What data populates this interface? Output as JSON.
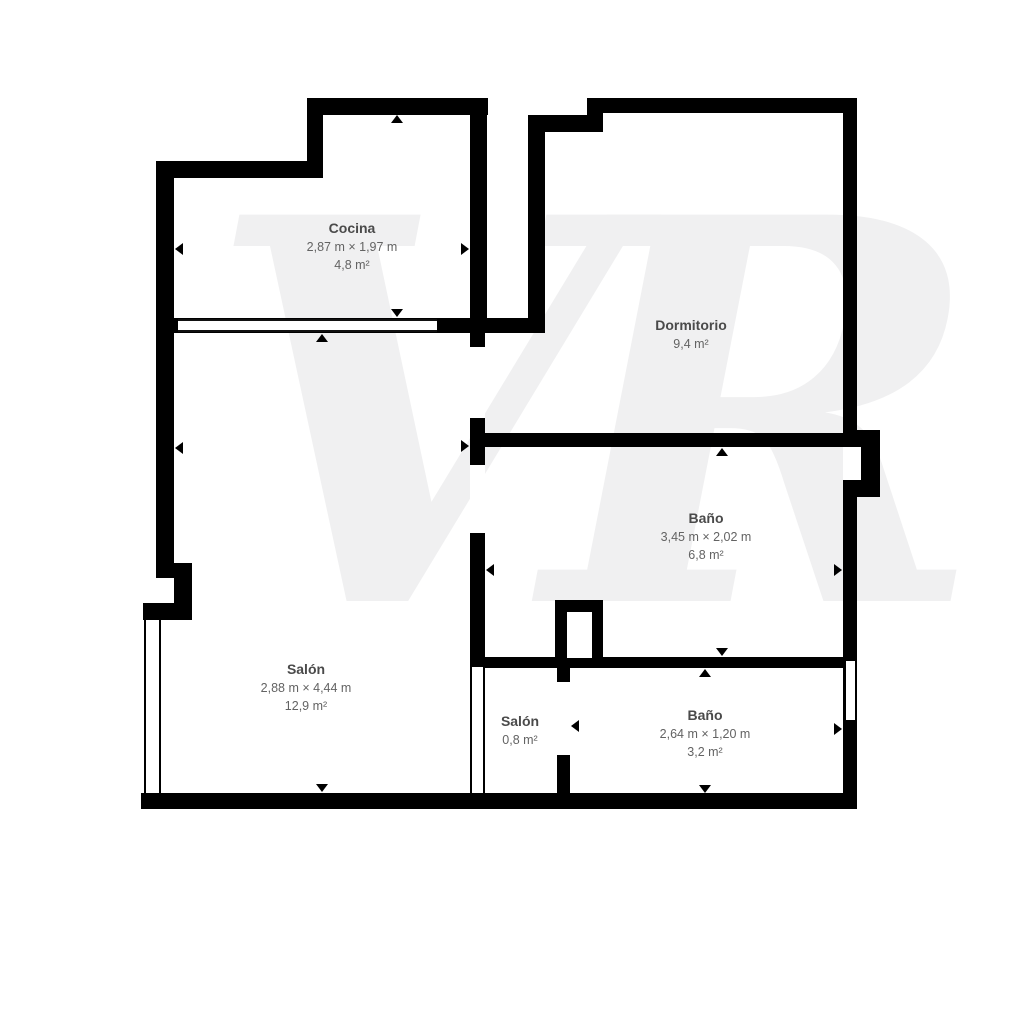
{
  "watermark_text": "VR",
  "rooms": [
    {
      "id": "cocina",
      "name": "Cocina",
      "dimensions": "2,87 m × 1,97 m",
      "area": "4,8 m²"
    },
    {
      "id": "dormitorio",
      "name": "Dormitorio",
      "dimensions": "",
      "area": "9,4 m²"
    },
    {
      "id": "bano-grande",
      "name": "Baño",
      "dimensions": "3,45 m × 2,02 m",
      "area": "6,8 m²"
    },
    {
      "id": "salon-grande",
      "name": "Salón",
      "dimensions": "2,88 m × 4,44 m",
      "area": "12,9 m²"
    },
    {
      "id": "salon-pequeno",
      "name": "Salón",
      "dimensions": "",
      "area": "0,8 m²"
    },
    {
      "id": "bano-pequeno",
      "name": "Baño",
      "dimensions": "2,64 m × 1,20 m",
      "area": "3,2 m²"
    }
  ],
  "colors": {
    "wall": "#000000",
    "floor": "#ffffff",
    "watermark": "#f0f0f1",
    "label_title": "#4a4a4a",
    "label_sub": "#636363"
  }
}
